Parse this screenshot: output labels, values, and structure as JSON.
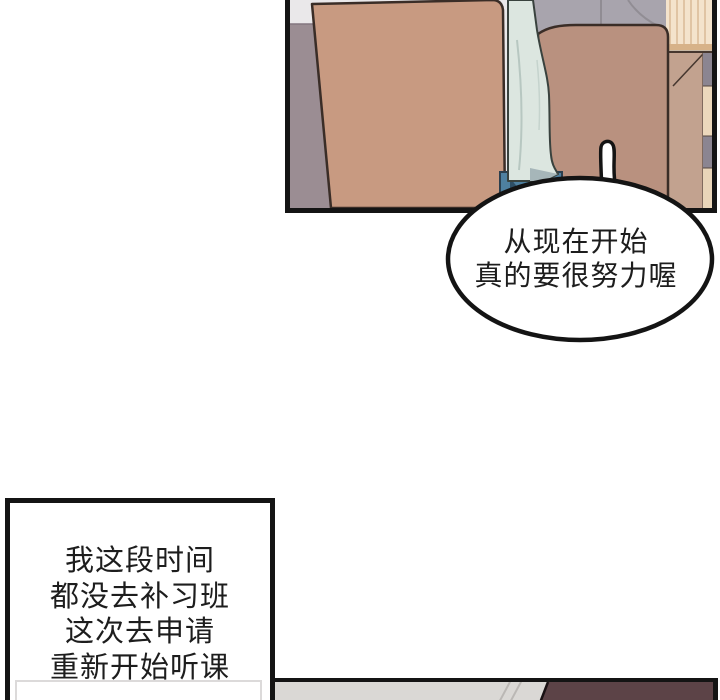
{
  "type": "webtoon-comic-page",
  "speech_bubble": {
    "lines": [
      "从现在开始",
      "真的要很努力喔"
    ]
  },
  "caption_box": {
    "lines": [
      "我这段时间",
      "都没去补习班",
      "这次去申请",
      "重新开始听课"
    ]
  },
  "palette": {
    "outline": "#141414",
    "wall_light": "#eae8ea",
    "wall_mauve": "#9b8d93",
    "chair_left_tan": "#c89a81",
    "chair_right_tan": "#b9917f",
    "shirt_mint": "#dce6e0",
    "jeans_blue": "#4e80a0",
    "jacket_gray": "#a8a4ad",
    "shelf_cream": "#f4e3cc",
    "shelf_stripe": "#d9b996",
    "desk_tan": "#c2a28f",
    "cabinet_gray": "#8b8591",
    "cabinet_beige": "#ecd8bc",
    "bottom_wall_gray": "#dad8d5",
    "hair_maroon": "#5c4347"
  }
}
